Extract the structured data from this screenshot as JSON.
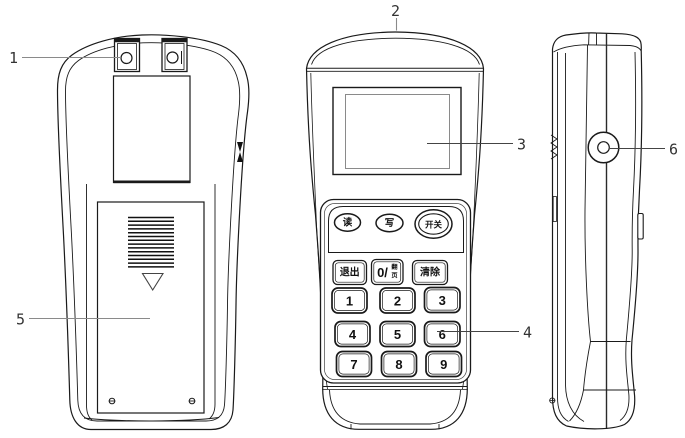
{
  "diagram": {
    "callouts": {
      "1": "1",
      "2": "2",
      "3": "3",
      "4": "4",
      "5": "5",
      "6": "6"
    },
    "front_panel": {
      "read_button": "读",
      "write_button": "写",
      "power_button": "开关",
      "exit_key": "退出",
      "zero_key_main": "0/",
      "zero_key_top": "翻",
      "zero_key_bottom": "页",
      "clear_key": "清除",
      "digit_keys": [
        "1",
        "2",
        "3",
        "4",
        "5",
        "6",
        "7",
        "8",
        "9"
      ]
    }
  }
}
